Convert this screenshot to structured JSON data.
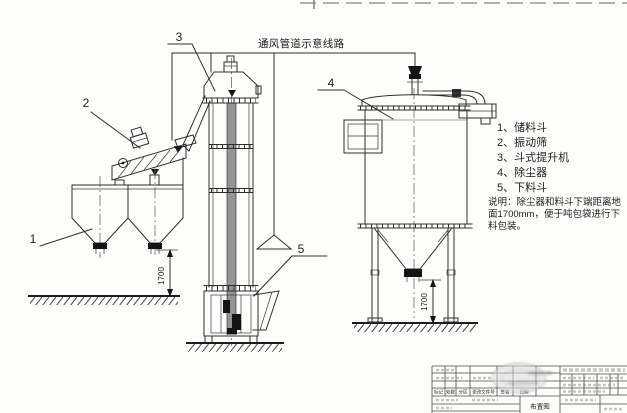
{
  "colors": {
    "line": "#2e2e2e",
    "paper": "#fdfdfc",
    "belt_gray": "#949494",
    "solid_black": "#141414"
  },
  "vent_label": "通风管道示意线路",
  "legend": {
    "items": [
      "1、储料斗",
      "2、振动筛",
      "3、斗式提升机",
      "4、除尘器",
      "5、下料斗"
    ]
  },
  "note": {
    "lines": [
      "说明：除尘器和料斗下端距离地",
      "面1700mm，便于吨包袋进行下",
      "料包装。"
    ]
  },
  "callouts": {
    "c1": "1",
    "c2": "2",
    "c3": "3",
    "c4": "4",
    "c5": "5"
  },
  "dimensions": {
    "hopper_height": "1700",
    "collector_height": "1700"
  },
  "title_block": {
    "title": "布置图",
    "revision_header": [
      "标记",
      "处数",
      "分区",
      "更改文件号",
      "签名",
      "日期"
    ]
  }
}
